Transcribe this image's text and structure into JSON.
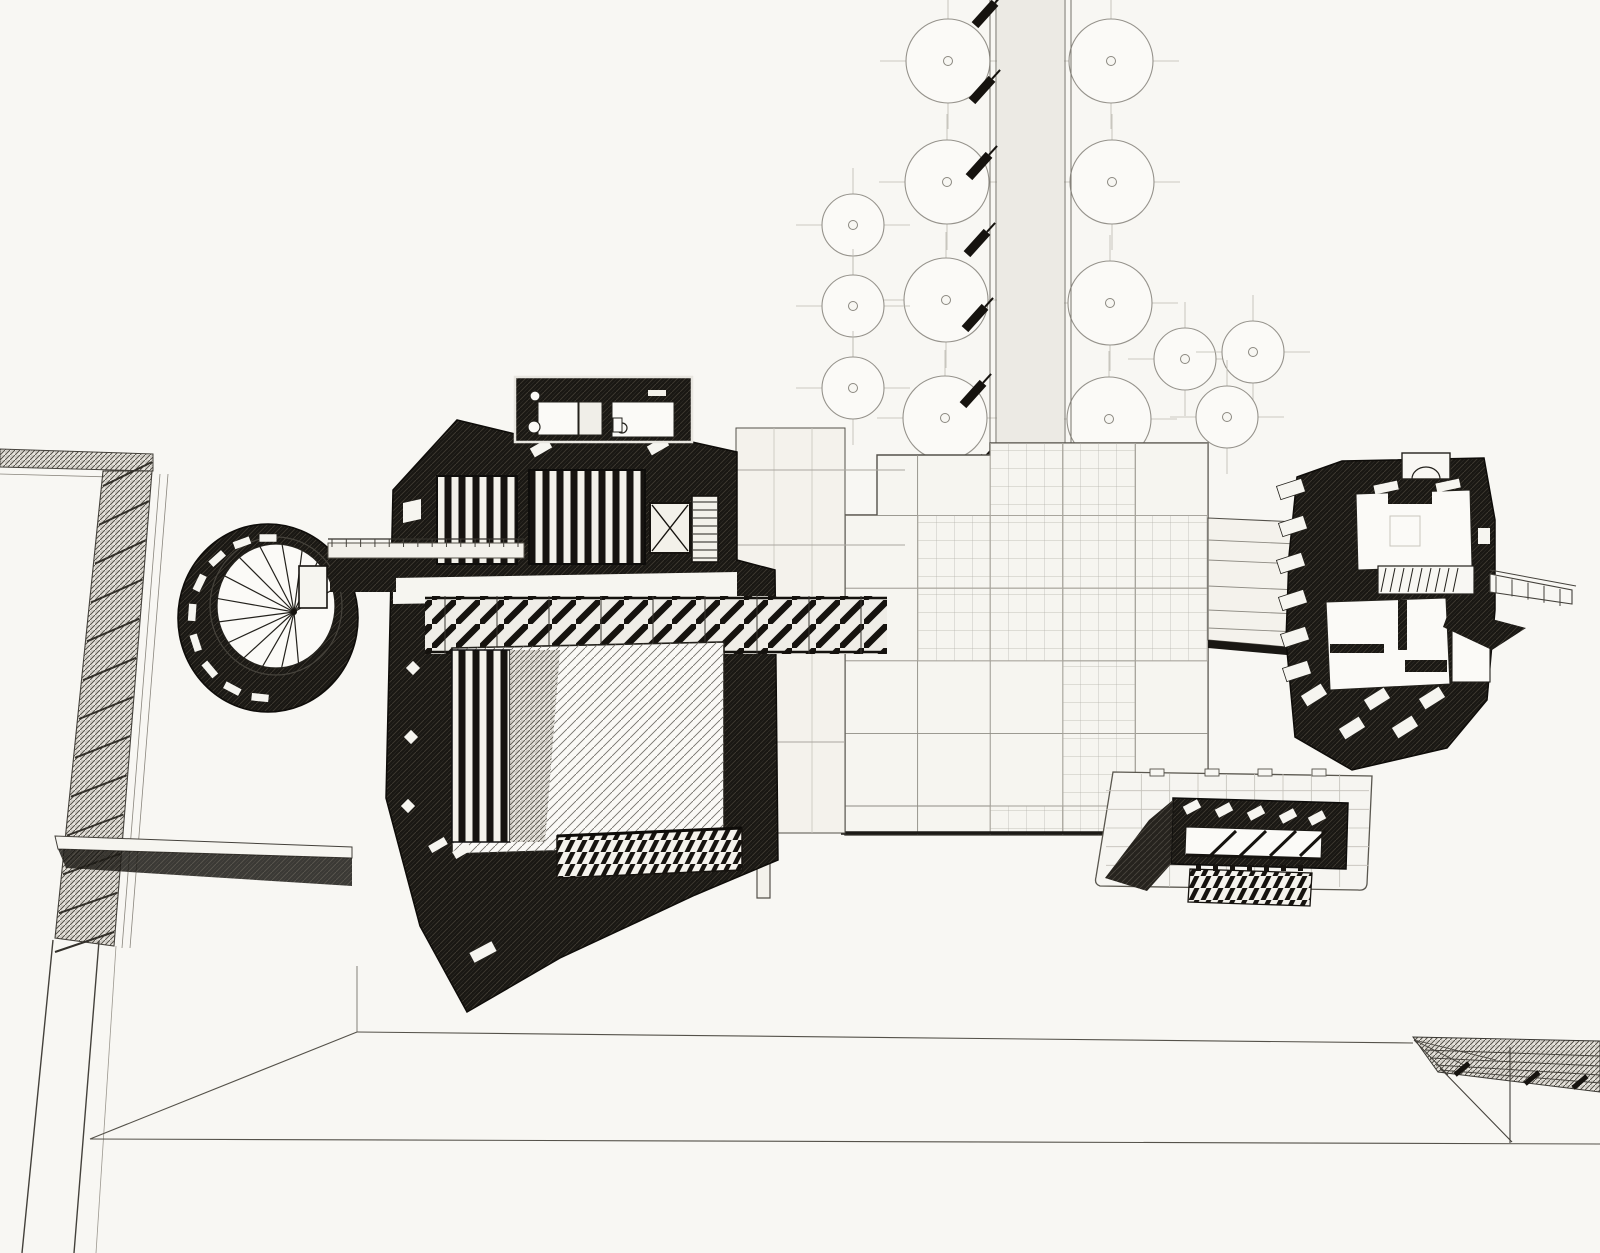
{
  "drawing": {
    "title": "architectural-site-axonometric",
    "paper_color": "#f8f7f3",
    "ink_color": "#16130f",
    "line_color": "#55524a",
    "faint_color": "#bcb9b1"
  },
  "trees": {
    "radius_large": 42,
    "radius_small": 31,
    "center_dot_radius": 4.5,
    "crosshair_overhang": 26,
    "large": [
      [
        948,
        61
      ],
      [
        947,
        182
      ],
      [
        946,
        300
      ],
      [
        945,
        418
      ],
      [
        1111,
        61
      ],
      [
        1112,
        182
      ],
      [
        1110,
        303
      ],
      [
        1109,
        419
      ]
    ],
    "small": [
      [
        853,
        225
      ],
      [
        853,
        306
      ],
      [
        853,
        388
      ],
      [
        1185,
        359
      ],
      [
        1253,
        352
      ],
      [
        1227,
        417
      ]
    ]
  },
  "road": {
    "x_left1": 990,
    "x_left2": 996,
    "x_right1": 1065,
    "x_right2": 1071,
    "y_top": 0,
    "y_bottom": 452
  },
  "bollards": {
    "w": 30,
    "h": 9,
    "angle": -48,
    "points": [
      [
        985,
        14
      ],
      [
        982,
        90
      ],
      [
        979,
        166
      ],
      [
        977,
        243
      ],
      [
        975,
        318
      ],
      [
        973,
        394
      ],
      [
        975,
        468
      ],
      [
        973,
        540
      ],
      [
        971,
        624
      ],
      [
        1046,
        622
      ],
      [
        1044,
        697
      ],
      [
        1042,
        769
      ]
    ]
  },
  "plaza": {
    "x": 845,
    "y": 443,
    "cell": 72.6,
    "cols": 5,
    "rows": 6,
    "bottom": 835,
    "fine_cells": [
      [
        1,
        1
      ],
      [
        1,
        2
      ],
      [
        2,
        0
      ],
      [
        2,
        1
      ],
      [
        2,
        2
      ],
      [
        3,
        0
      ],
      [
        3,
        1
      ],
      [
        3,
        2
      ],
      [
        3,
        3
      ],
      [
        3,
        4
      ],
      [
        4,
        1
      ],
      [
        4,
        2
      ],
      [
        2,
        5
      ],
      [
        3,
        5
      ]
    ]
  },
  "tower": {
    "cx": 268,
    "cy": 618,
    "rx": 90,
    "ry": 94,
    "inner_cx": 276,
    "inner_cy": 606,
    "inner_rx": 59,
    "inner_ry": 62,
    "hub": [
      294,
      612
    ],
    "spokes": 15,
    "spoke_start": 85,
    "spoke_end": 330,
    "slot_angles": [
      96,
      118,
      140,
      162,
      184,
      206,
      228,
      250,
      270
    ],
    "slot_radius": 76,
    "slot_w": 17,
    "slot_h": 7.5
  },
  "bridge": {
    "posts": 14,
    "x0": 332,
    "x1": 518,
    "rail_y": 539,
    "deck_top": 543,
    "deck_h": 15
  },
  "main_building": {
    "pier_windows": [
      [
        413,
        668
      ],
      [
        411,
        737
      ],
      [
        408,
        806
      ]
    ],
    "wedge_slots": [
      [
        438,
        845
      ],
      [
        462,
        851
      ]
    ],
    "court_slot": [
      483,
      952
    ],
    "clerestory": [
      [
        541,
        448
      ],
      [
        658,
        446
      ]
    ],
    "stair_treads": 8,
    "joist_posts": 9
  },
  "right_building": {
    "tier_slots": [
      [
        1291,
        489
      ],
      [
        1293,
        526
      ],
      [
        1291,
        563
      ],
      [
        1293,
        600
      ],
      [
        1295,
        637
      ],
      [
        1297,
        671
      ]
    ],
    "skylights": [
      [
        1314,
        695
      ],
      [
        1377,
        699
      ],
      [
        1432,
        698
      ],
      [
        1352,
        728
      ],
      [
        1405,
        727
      ]
    ],
    "stair_treads": 9,
    "balcony_posts": 5
  },
  "south_building": {
    "bar_slots": [
      [
        1192,
        807
      ],
      [
        1224,
        810
      ],
      [
        1256,
        813
      ],
      [
        1288,
        816
      ],
      [
        1317,
        818
      ]
    ],
    "struts": 4,
    "deck_posts": 7,
    "grid_cols": 8,
    "grid_rows": 5
  },
  "pylon": {
    "rungs": 13,
    "top": [
      [
        103,
        474
      ],
      [
        152,
        474
      ]
    ],
    "bottom": [
      [
        55,
        940
      ],
      [
        114,
        944
      ]
    ]
  },
  "ramp": {
    "ticks": [
      [
        1462,
        1069
      ],
      [
        1532,
        1078
      ],
      [
        1580,
        1082
      ]
    ]
  }
}
